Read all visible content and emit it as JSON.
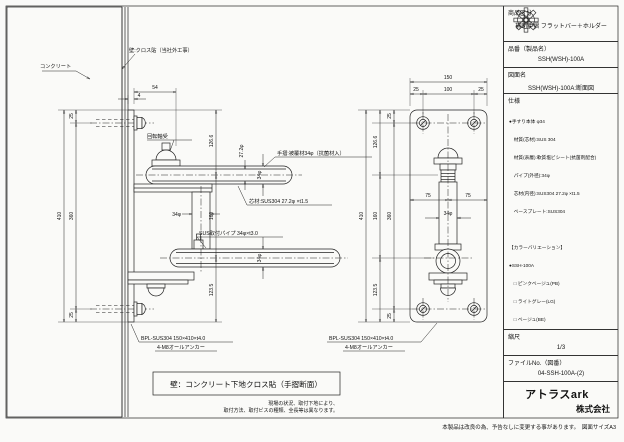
{
  "title_block": {
    "product_category_label": "商品区分",
    "product_category": "補助手摺 フラットバー＋ホルダー",
    "part_no_label": "品番（製品名）",
    "part_no": "SSH(WSH)-100A",
    "drawing_name_label": "図面名",
    "drawing_name": "SSH(WSH)-100A:断面図",
    "spec_label": "仕様",
    "spec_lines": [
      "●手すり本体 φ34",
      "　材質(芯材):SUS 304",
      "　材質(表層):軟質塩ビシート(抗菌剤配合)",
      "　パイプ(外径):34φ",
      "　芯材(内径):SUS304 27.2φ ×t1.5",
      "　ベースプレート:SUS304",
      "",
      "【カラーバリエーション】",
      "●SSH-100A",
      "　□ ピンクベージュ(PB)",
      "　□ ライトグレー(LG)",
      "　□ ベージュ(BE)",
      "",
      "●WSH-100A",
      "　□ ライト(木目調)",
      "　□ ナチュラル(木目調)"
    ],
    "scale_label": "縮尺",
    "scale_value": "1/3",
    "file_label": "ファイルNo.（図番）",
    "file_value": "04-SSH-100A-(2)",
    "company_name": "アトラスark",
    "company_suffix": "株式会社"
  },
  "drawing": {
    "labels": {
      "concrete": "コンクリート",
      "wall": "壁:クロス貼（当社外工事）",
      "bearing": "回転軸受",
      "handrail": "手摺:被覆材34φ（抗菌材入）",
      "core": "芯材:SUS304 27.2φ ×t1.5",
      "mount_pipe": "SUS取付パイプ 34φ×t3.0",
      "baseplate": "BPL-SUS304 150×410×t4.0",
      "anchor": "4-M8オールアンカー"
    },
    "dims": {
      "v54": "54",
      "v4": "4",
      "v25": "25",
      "v360": "360",
      "v410": "410",
      "v126_6": "126.6",
      "v160": "160",
      "v123_5": "123.5",
      "v150": "150",
      "v100": "100",
      "v75": "75",
      "v34": "34φ",
      "v27_2": "27.2φ"
    },
    "caption": "壁：コンクリート下地クロス貼（手摺断面）",
    "notes": [
      "現場の状況、取付下地により、",
      "取付方法、取付ビスの種類、全長等は異なります。"
    ],
    "footer": "本製品は改良の為、予告なしに変更する事があります。　図面サイズA3"
  }
}
